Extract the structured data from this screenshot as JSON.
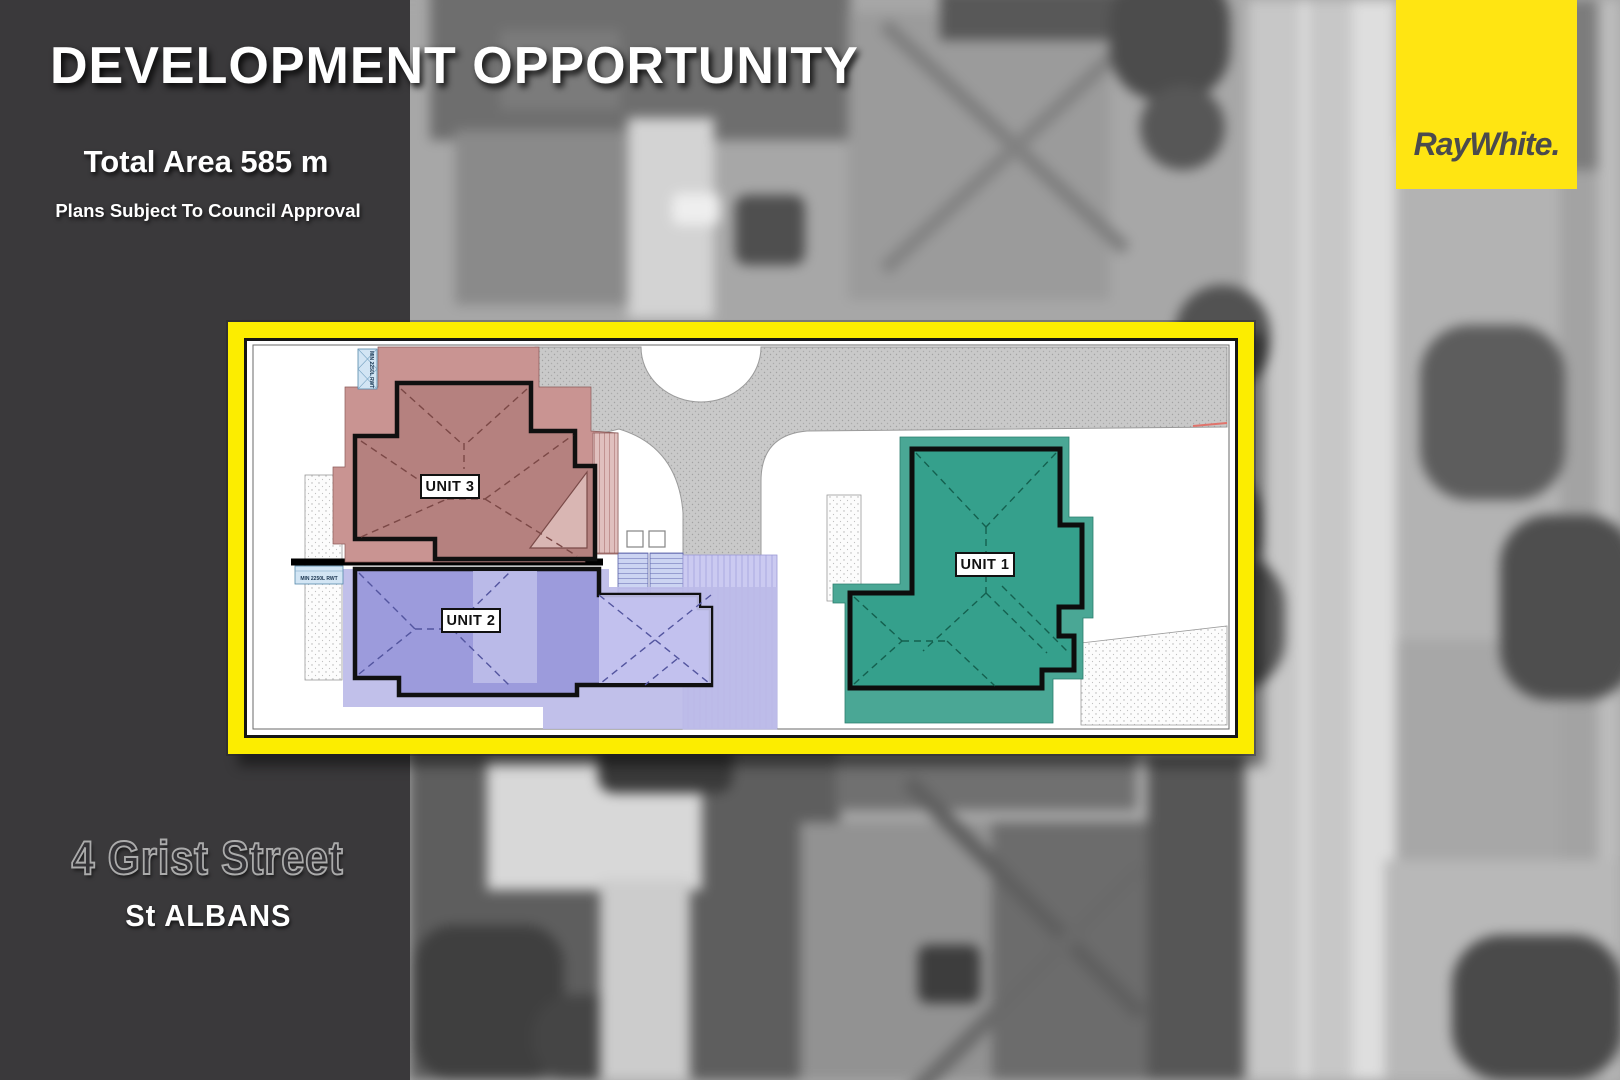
{
  "header": {
    "title": "DEVELOPMENT OPPORTUNITY",
    "total_area": "Total Area 585 m",
    "approval_note": "Plans Subject To Council Approval"
  },
  "address": {
    "street": "4 Grist Street",
    "suburb": "St ALBANS"
  },
  "brand": {
    "name": "RayWhite.",
    "color": "#ffe512"
  },
  "plan": {
    "frame_color": "#fced00",
    "units": [
      {
        "label": "UNIT 1",
        "color": "#35a08c"
      },
      {
        "label": "UNIT 2",
        "color": "#9c9bdc"
      },
      {
        "label": "UNIT 3",
        "color": "#b5817f"
      }
    ],
    "tank_labels": [
      "MIN 2250L RWT",
      "MIN 2250L RWT"
    ]
  }
}
